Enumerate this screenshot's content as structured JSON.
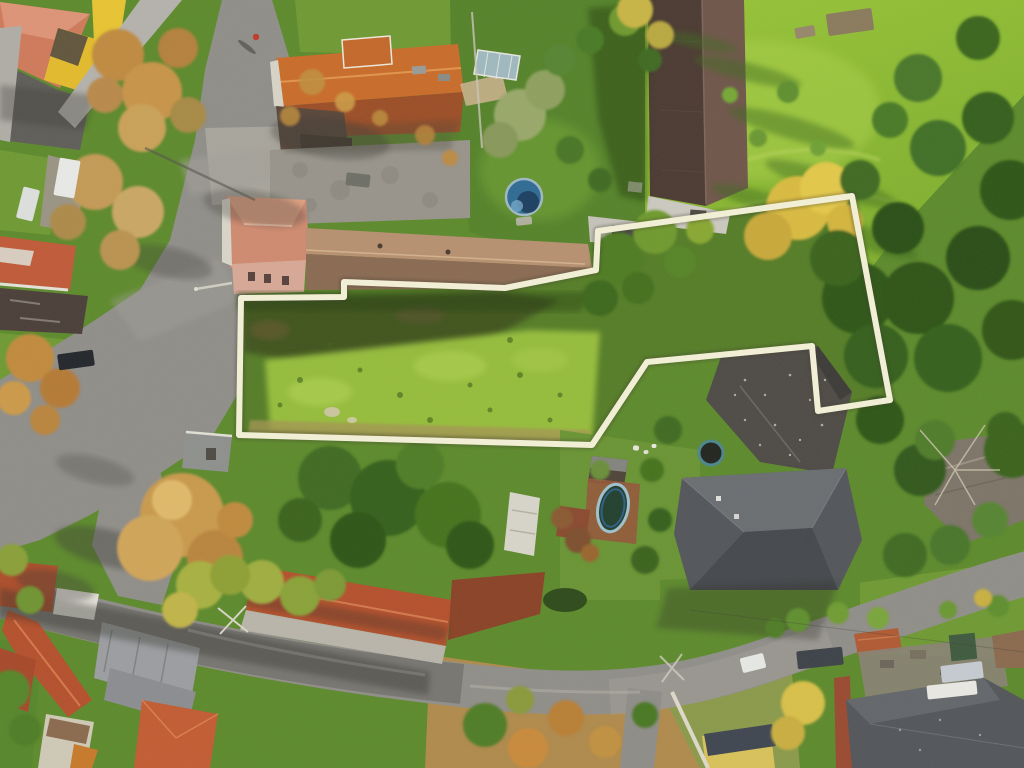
{
  "image": {
    "kind": "aerial-drone-photograph",
    "season": "autumn",
    "subject": "village land parcel marked with a cream boundary outline, surrounded by houses, barns, gardens and two roads"
  },
  "palette": {
    "meadow": "#85b431",
    "meadowLime": "#a9cf49",
    "lawn": "#5d8a2c",
    "lawnDark": "#3f6b20",
    "property": "#557d27",
    "lime": "#9ac13e",
    "road": "#908e89",
    "roadLight": "#a3a099",
    "roadShadow": "#5e5d59",
    "roofOrange": "#c96c2a",
    "roofOrangeDark": "#9c4e26",
    "roofSalmon": "#cf7a5a",
    "roofTan": "#b79070",
    "roofTanDark": "#8a6a52",
    "roofBarnW": "#4b3a32",
    "roofBarnE": "#6f564a",
    "roofSlate": "#53565a",
    "roofRed": "#b5502c",
    "roofGray": "#9b9da0",
    "dryGrass": "#b08a4c",
    "yellowWall": "#e3bb2c",
    "boundary": "#f4f1d8",
    "boundaryHalo": "#3f3f2e"
  },
  "boundary": {
    "points": "241,298 344,297 344,282 505,288 596,270 598,231 852,196 890,400 818,411 812,346 647,362 592,445 239,435",
    "width": 6,
    "halo_width": 10
  },
  "markers": [
    {
      "name": "white-van",
      "shape": "rect",
      "x": 67,
      "y": 178,
      "w": 21,
      "h": 38,
      "rot": 10,
      "fill": "#e9eae6"
    },
    {
      "name": "white-car",
      "shape": "rect",
      "x": 28,
      "y": 204,
      "w": 17,
      "h": 32,
      "rot": 14,
      "fill": "#dde0dc"
    },
    {
      "name": "black-car",
      "shape": "rect",
      "x": 76,
      "y": 360,
      "w": 36,
      "h": 16,
      "rot": -8,
      "fill": "#23262b"
    },
    {
      "name": "utility-trailer",
      "shape": "rect",
      "x": 358,
      "y": 180,
      "w": 24,
      "h": 13,
      "rot": 6,
      "fill": "#6e7066"
    },
    {
      "name": "dark-car",
      "shape": "rect",
      "x": 820,
      "y": 658,
      "w": 46,
      "h": 18,
      "rot": -6,
      "fill": "#3d4248"
    },
    {
      "name": "white-car-small",
      "shape": "rect",
      "x": 753,
      "y": 663,
      "w": 24,
      "h": 15,
      "rot": -14,
      "fill": "#e7e9e5"
    },
    {
      "name": "silver-car",
      "shape": "rect",
      "x": 962,
      "y": 672,
      "w": 42,
      "h": 17,
      "rot": -7,
      "fill": "#c6cbd1"
    },
    {
      "name": "round-pool",
      "shape": "circle",
      "x": 524,
      "y": 197,
      "r": 18,
      "fill": "#2f6b94",
      "stroke": "#9fb9c4",
      "sw": 2.5
    },
    {
      "name": "round-pool-cover",
      "shape": "circle",
      "x": 528,
      "y": 202,
      "r": 11,
      "fill": "#1c3c5c",
      "opacity": 0.92
    },
    {
      "name": "round-pool-highlight",
      "shape": "circle",
      "x": 517,
      "y": 206,
      "r": 6,
      "fill": "#6fa3c4",
      "opacity": 0.85
    },
    {
      "name": "pool-deck",
      "shape": "rect",
      "x": 524,
      "y": 221,
      "w": 16,
      "h": 8,
      "rot": -6,
      "fill": "#b9b6aa",
      "opacity": 0.9
    },
    {
      "name": "oval-pool",
      "shape": "ellipse",
      "x": 613,
      "y": 508,
      "rx": 15,
      "ry": 24,
      "rot": 12,
      "fill": "#22402e",
      "stroke": "#9fc2cc",
      "sw": 3
    },
    {
      "name": "oval-pool-rim",
      "shape": "ellipse",
      "x": 613,
      "y": 508,
      "rx": 11,
      "ry": 19,
      "rot": 12,
      "fill": "none",
      "stroke": "#2e5e86",
      "sw": 2
    },
    {
      "name": "trampoline",
      "shape": "circle",
      "x": 711,
      "y": 453,
      "r": 12,
      "fill": "#22251f",
      "stroke": "#4d868d",
      "sw": 3
    },
    {
      "name": "pedestrian",
      "shape": "circle",
      "x": 256,
      "y": 37,
      "r": 3.2,
      "fill": "#c23a28"
    },
    {
      "name": "pedestrian-shadow",
      "shape": "ellipse",
      "x": 247,
      "y": 47,
      "rx": 11,
      "ry": 2.5,
      "rot": 38,
      "fill": "#3d3d38",
      "opacity": 0.55
    },
    {
      "name": "roof-banner",
      "shape": "rect",
      "x": 952,
      "y": 690,
      "w": 50,
      "h": 14,
      "rot": -6,
      "fill": "#eae8e2"
    },
    {
      "name": "garden-bed",
      "shape": "rect",
      "x": 850,
      "y": 22,
      "w": 46,
      "h": 22,
      "rot": -8,
      "fill": "#8a7a5c"
    },
    {
      "name": "stone-pile",
      "shape": "rect",
      "x": 805,
      "y": 32,
      "w": 20,
      "h": 11,
      "rot": -10,
      "fill": "#97876a"
    },
    {
      "name": "garden-chair-1",
      "shape": "rect",
      "x": 636,
      "y": 448,
      "w": 6,
      "h": 5,
      "rot": 8,
      "fill": "#e8e6da"
    },
    {
      "name": "garden-chair-2",
      "shape": "rect",
      "x": 646,
      "y": 452,
      "w": 5,
      "h": 4,
      "rot": -6,
      "fill": "#e3e1d5"
    },
    {
      "name": "garden-chair-3",
      "shape": "rect",
      "x": 654,
      "y": 446,
      "w": 5,
      "h": 4,
      "rot": 4,
      "fill": "#eceadf"
    }
  ]
}
